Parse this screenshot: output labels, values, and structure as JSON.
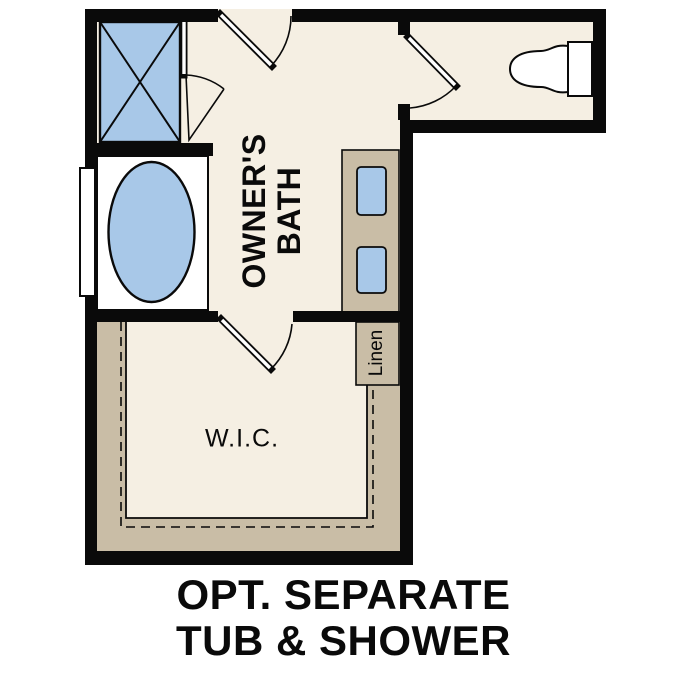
{
  "title": "Owner's bath floor plan option",
  "colors": {
    "background": "#ffffff",
    "floor": "#f5efe3",
    "cabinet": "#c9bda6",
    "fixture": "#a8c8e8",
    "wall": "#0a0a0a"
  },
  "rooms": {
    "owners_bath": {
      "lines": [
        "OWNER'S",
        "BATH"
      ]
    },
    "wic": {
      "label": "W.I.C."
    },
    "linen": {
      "label": "Linen"
    }
  },
  "caption": {
    "line1": "OPT. SEPARATE",
    "line2": "TUB & SHOWER"
  },
  "fixtures": [
    "shower-with-glass-door",
    "soaking-tub",
    "window",
    "toilet",
    "double-sink-vanity",
    "linen-closet",
    "walk-in-closet-rod-and-shelf"
  ]
}
